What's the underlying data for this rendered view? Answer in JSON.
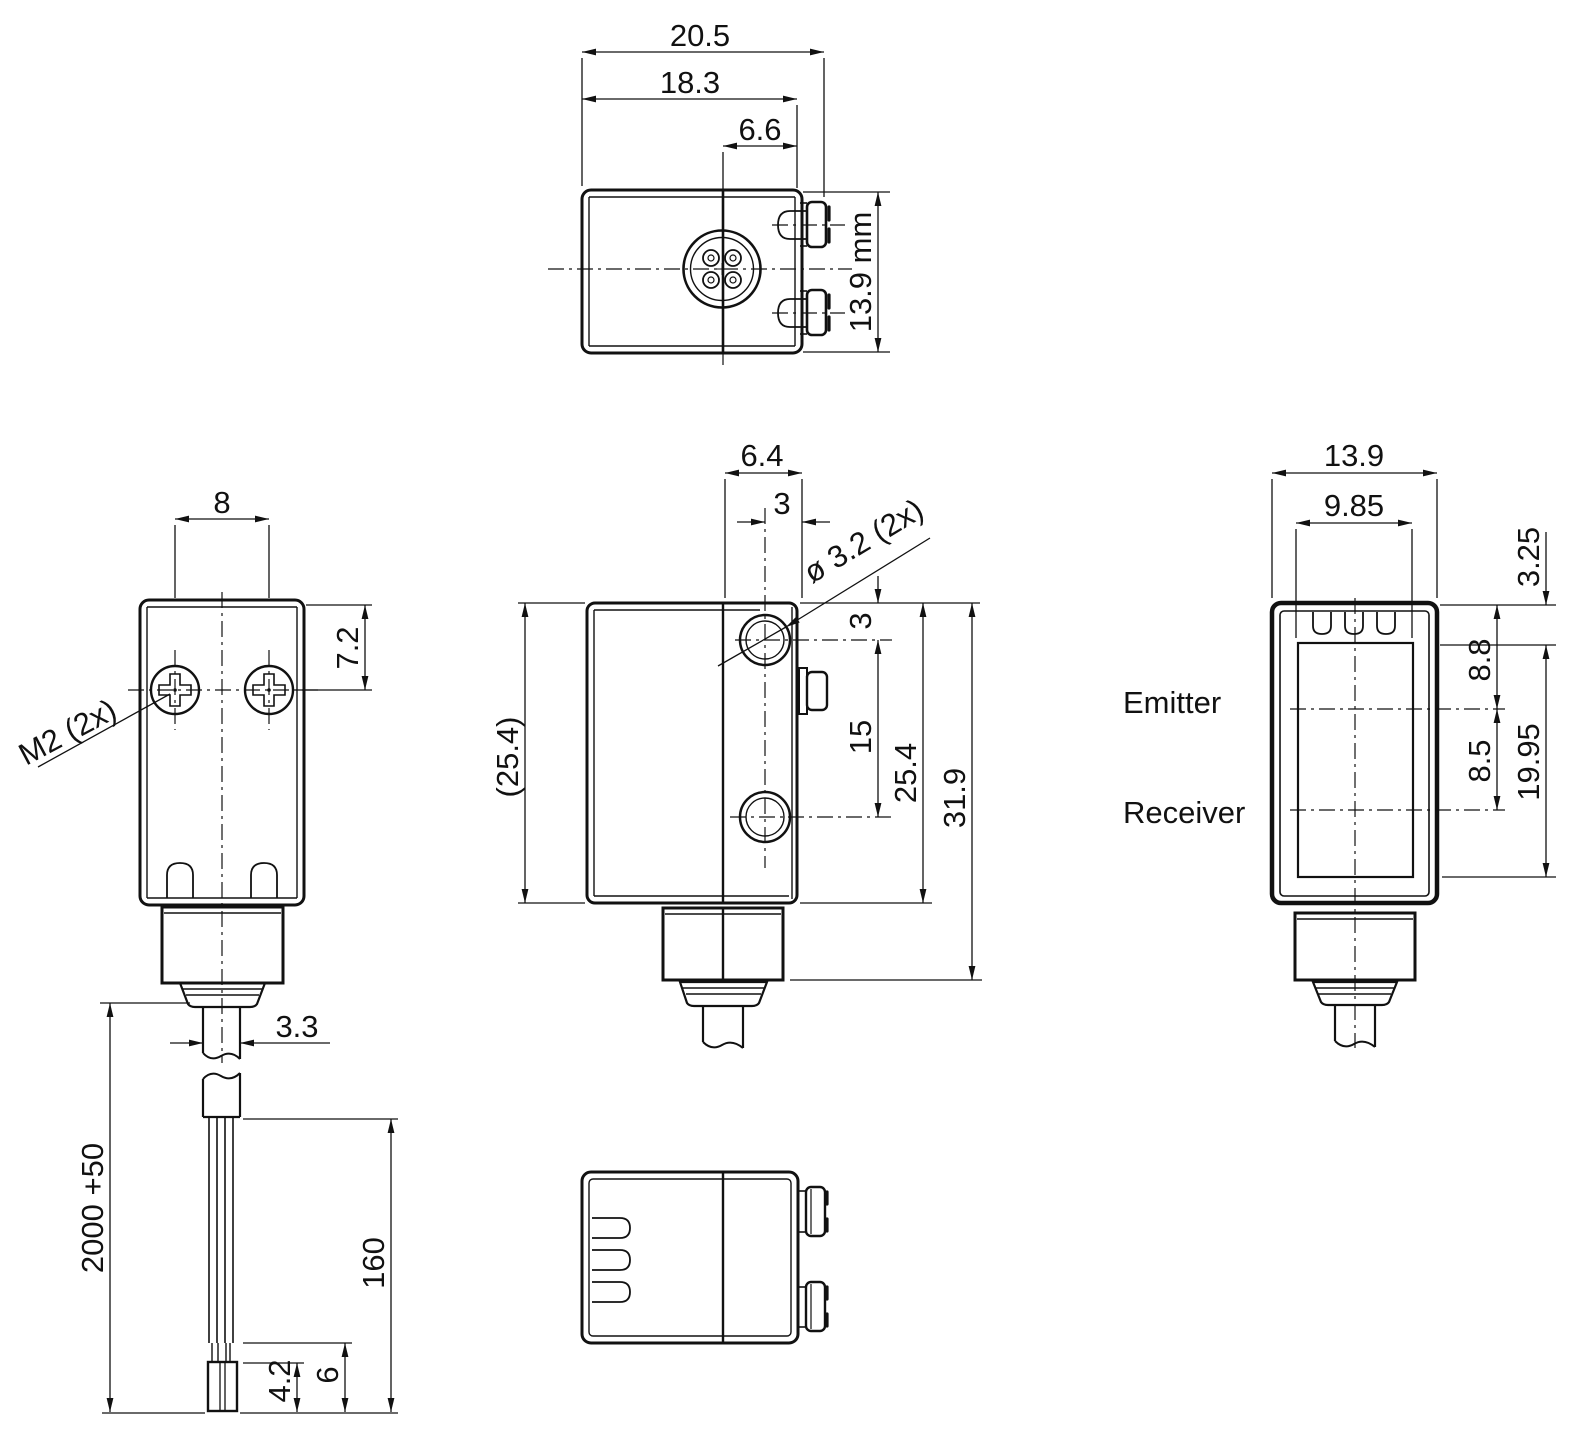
{
  "drawing": {
    "type": "technical-dimension-drawing",
    "subject": "photoelectric sensor with cable",
    "line_color": "#111111",
    "background": "#ffffff"
  },
  "views": {
    "top": {
      "dim_total_width": "20.5",
      "dim_body_width": "18.3",
      "dim_connector_offset": "6.6",
      "dim_height": "13.9 mm"
    },
    "back": {
      "dim_screw_spacing": "8",
      "dim_screw_from_top": "7.2",
      "label_screws": "M2 (2x)",
      "dim_cable_diameter": "3.3",
      "dim_cable_length": "2000 +50",
      "dim_cable_end": "160",
      "dim_ferrule": "4.2",
      "dim_tip": "6"
    },
    "side": {
      "dim_front_depth": "6.4",
      "dim_axis_to_face": "3",
      "label_holes": "ø 3.2 (2x)",
      "dim_hole_from_top": "3",
      "dim_hole_spacing": "15",
      "dim_body_height": "25.4",
      "dim_body_height_ref": "(25.4)",
      "dim_total_height": "31.9"
    },
    "front": {
      "dim_width": "13.9",
      "dim_window_width": "9.85",
      "dim_top_to_window": "3.25",
      "dim_top_to_emitter": "8.8",
      "dim_emitter_to_receiver": "8.5",
      "dim_window_height": "19.95",
      "label_emitter": "Emitter",
      "label_receiver": "Receiver"
    }
  }
}
